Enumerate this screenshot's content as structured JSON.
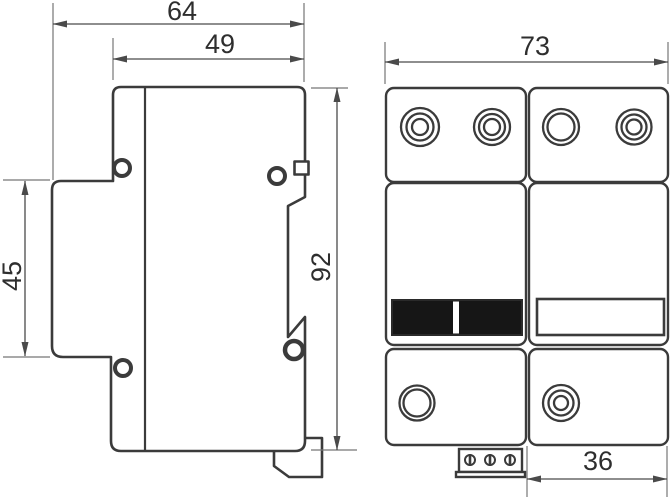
{
  "drawing": {
    "type": "technical-dimension-drawing",
    "side_view": {
      "total_width": "64",
      "body_width": "49",
      "clip_section_height": "45",
      "total_height": "92"
    },
    "front_view": {
      "total_width": "73",
      "module_width": "36"
    },
    "colors": {
      "outline": "#3b3b3b",
      "dimension_lines": "#4a4a4a",
      "extension_lines": "#767676",
      "text": "#2e2e2e",
      "indicator_window_fill": "#161616",
      "background": "#ffffff"
    }
  }
}
